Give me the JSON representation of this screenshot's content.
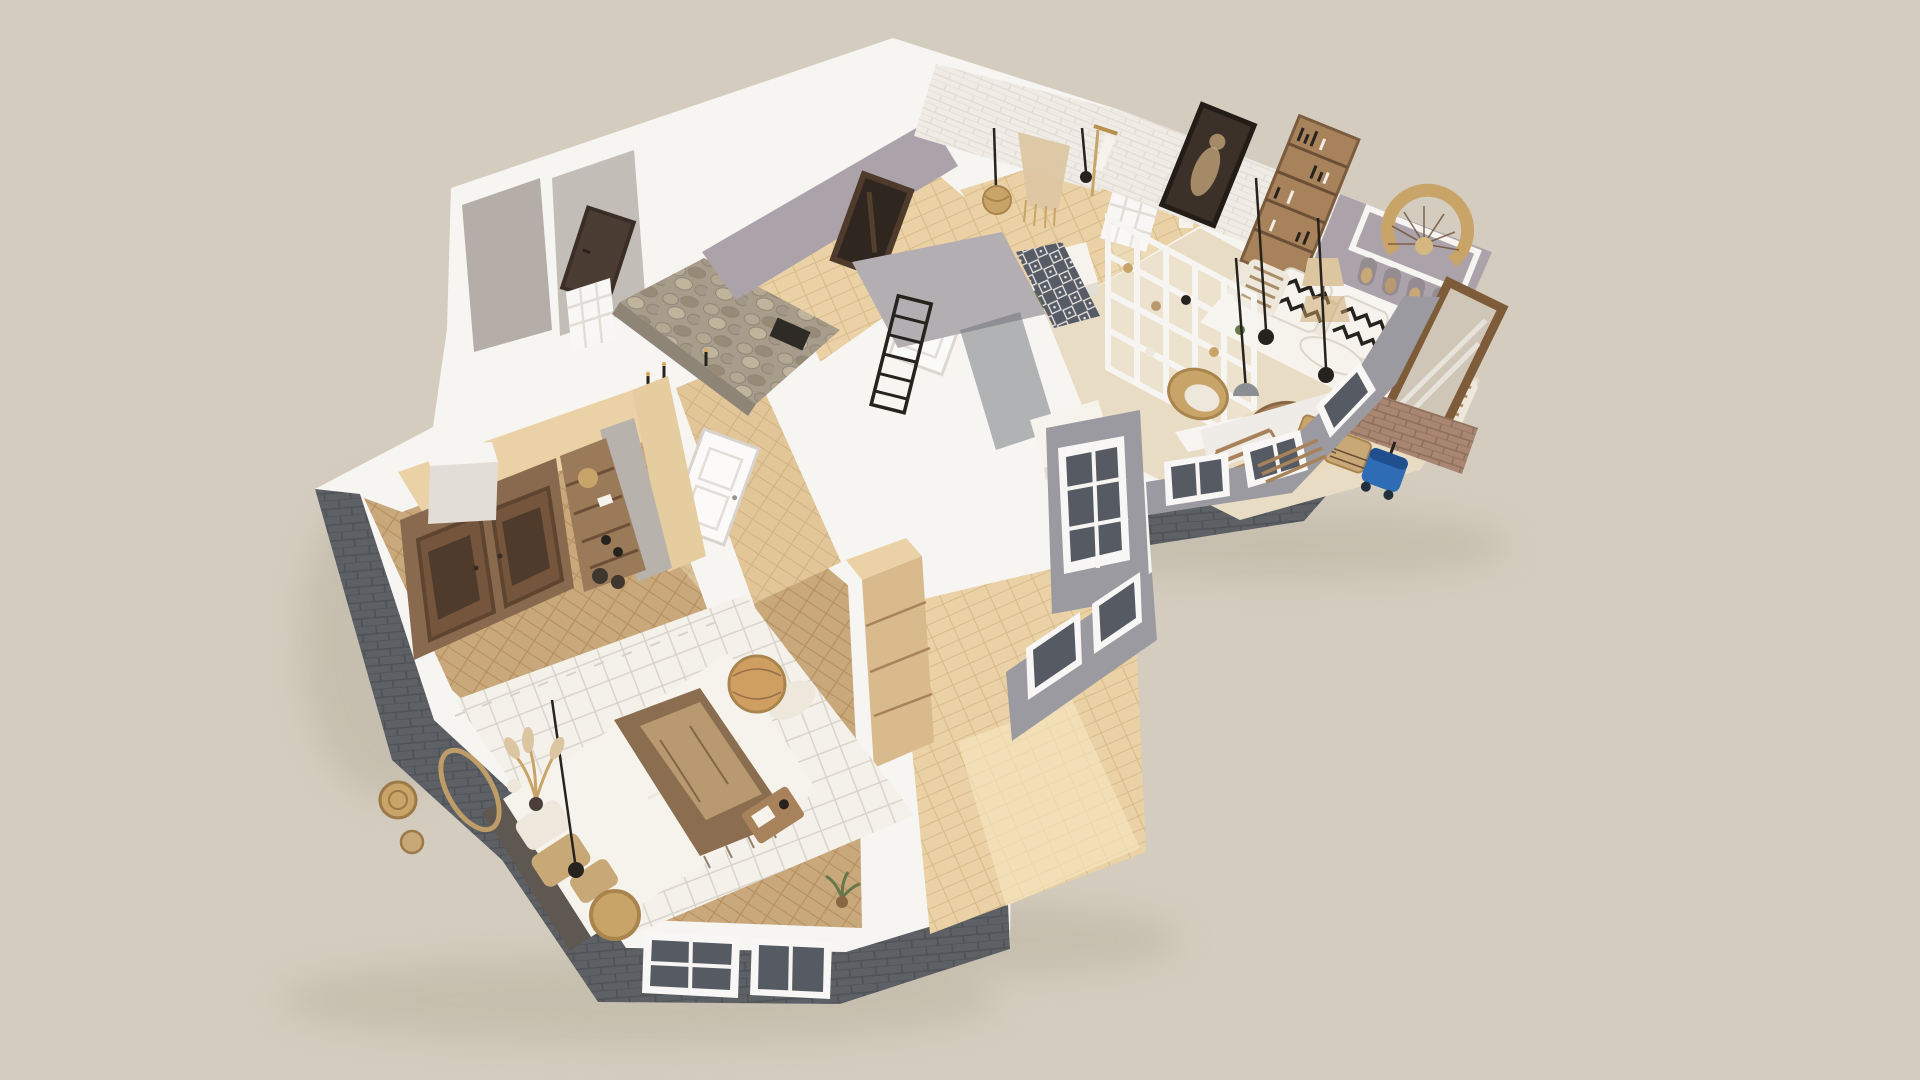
{
  "scene": {
    "type": "3d-floorplan-cutaway-render",
    "view": "axonometric top-down",
    "style": "scandinavian-boho apartment"
  },
  "colors": {
    "background": "#d4cdbf",
    "shadow": "#b9b09e",
    "wall-top": "#f7f5f2",
    "wall-side": "#e2ddd7",
    "wall-inner": "#eceae5",
    "hall-wall": "#aba3a9",
    "bath-wall": "#b3aeb2",
    "balcony-wall": "#9a9aa0",
    "closet-wall": "#c3bdb7",
    "closet-floor": "#b5aea8",
    "brick-dark": "#5d6064",
    "brick-dark-line": "#4e5155",
    "brick-tan": "#a98671",
    "brick-tan-line": "#8d6e5a",
    "brick-white": "#efebe5",
    "brick-white-line": "#e2dbd2",
    "stone": "#a89d8b",
    "stone-dark": "#8f8576",
    "wood-light": "#ead2a6",
    "wood-light-line": "#d8bc8a",
    "wood-floor": "#c9a87c",
    "wood-floor-line": "#b6905f",
    "wood-mid": "#a8825a",
    "wood-dark": "#6d4f37",
    "wardrobe": "#8a6a4e",
    "wardrobe-door": "#75563c",
    "glass-dark": "#565b63",
    "window-frame": "#f8f7f5",
    "textile-white": "#f6f3ed",
    "textile-cream": "#eee8dc",
    "throw-brown": "#8a6e4f",
    "throw-tan": "#b99970",
    "pillow-tan": "#c9a878",
    "headboard": "#5f5850",
    "rug-white": "#f4f1ea",
    "rug-line": "#d8d3c9",
    "rattan": "#c9a468",
    "black": "#26221e",
    "plant": "#66774b",
    "blue": "#2e6cb5",
    "blue-dark": "#1f4f8c",
    "tile-bg": "#565b66",
    "mirror-glass": "#cfc6b8",
    "frame-wood": "#7e5c3a",
    "lamp-shade": "#dcc6a2",
    "floor-beige": "#e9dcc4",
    "sunlight": "#f6e6c0"
  },
  "rooms": [
    {
      "id": "bedroom",
      "furniture": [
        "double-bed",
        "headboard",
        "wardrobe",
        "open-shelf",
        "pouf",
        "diamond-rug",
        "pendant-lamp",
        "wicker-table",
        "tray-table",
        "dried-pampas",
        "woven-wall-plates",
        "tall-cabinet"
      ]
    },
    {
      "id": "corridor",
      "furniture": [
        "bedroom-door"
      ]
    },
    {
      "id": "shower-room",
      "furniture": [
        "stone-walls",
        "shower-fixture",
        "candles"
      ]
    },
    {
      "id": "closet",
      "furniture": [
        "dark-door",
        "lattice-screen"
      ]
    },
    {
      "id": "entry-hall",
      "furniture": [
        "wall-mirror"
      ]
    },
    {
      "id": "dressing-room",
      "furniture": [
        "clothes-rack",
        "macrame-hanging",
        "rattan-pendant",
        "portrait-painting",
        "console-bench",
        "potted-palm"
      ]
    },
    {
      "id": "living-room",
      "furniture": [
        "sofa",
        "zigzag-pillows",
        "striped-pillows",
        "ladder-bookshelf",
        "niche-accent-wall",
        "woven-fan-decor",
        "grid-partition",
        "coffee-table",
        "wicker-chair",
        "table-lamp",
        "pendant-lights",
        "leaning-mirror",
        "round-rug"
      ]
    },
    {
      "id": "laundry-nook",
      "furniture": [
        "tan-brick-wall",
        "wicker-baskets",
        "wet-vacuum",
        "drying-ladder"
      ]
    },
    {
      "id": "bathroom",
      "furniture": [
        "towel-ladder",
        "patterned-tile-wall",
        "glass-screen",
        "white-door",
        "console"
      ]
    },
    {
      "id": "empty-room",
      "furniture": [
        "potted-plant"
      ]
    },
    {
      "id": "balcony",
      "furniture": [
        "window-wall",
        "tall-window",
        "drying-poles"
      ]
    }
  ]
}
